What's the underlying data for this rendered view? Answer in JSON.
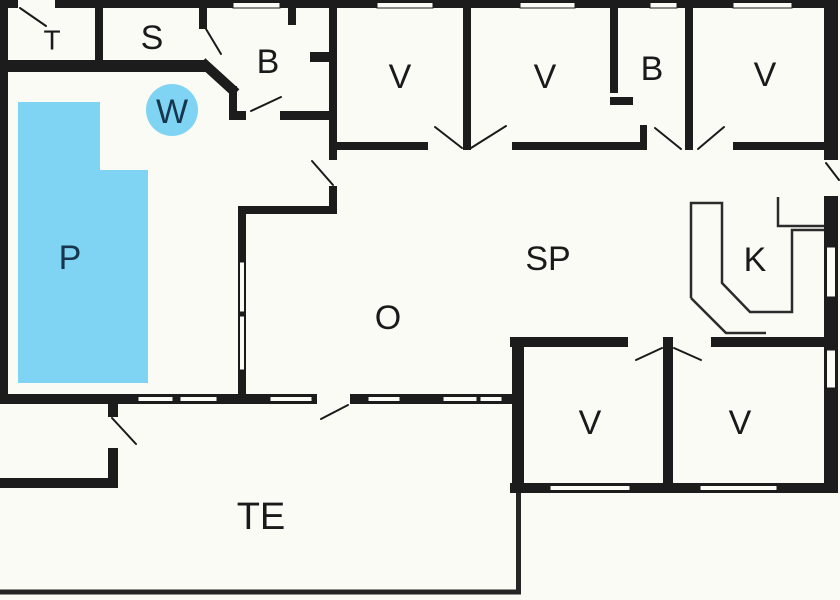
{
  "colors": {
    "pool": "#7ED4F2",
    "wall": "#1C1C1C",
    "text": "#1A1A1A",
    "water_text": "#17364E",
    "background": "#FBFBF6"
  },
  "rooms": {
    "toilet": {
      "label": "T"
    },
    "sauna": {
      "label": "S"
    },
    "bathroom_left": {
      "label": "B"
    },
    "whirlpool": {
      "label": "W"
    },
    "pool": {
      "label": "P"
    },
    "bedroom_nw": {
      "label": "V"
    },
    "bedroom_n": {
      "label": "V"
    },
    "bathroom_right": {
      "label": "B"
    },
    "bedroom_ne": {
      "label": "V"
    },
    "dining": {
      "label": "SP"
    },
    "living": {
      "label": "O"
    },
    "kitchen": {
      "label": "K"
    },
    "bedroom_sw": {
      "label": "V"
    },
    "bedroom_se": {
      "label": "V"
    },
    "terrace": {
      "label": "TE"
    }
  }
}
